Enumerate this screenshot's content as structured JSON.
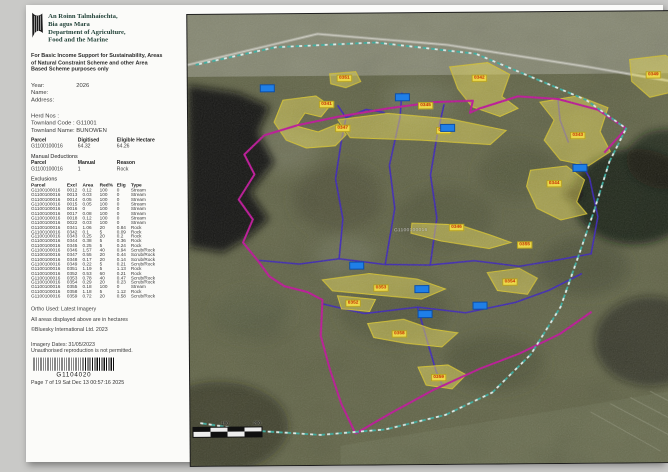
{
  "header": {
    "dept_irish_1": "An Roinn Talmhaíochta,",
    "dept_irish_2": "Bia agus Mara",
    "dept_english_1": "Department of Agriculture,",
    "dept_english_2": "Food and the Marine",
    "purpose": "For Basic Income Support for Sustainability, Areas of Natural Constraint Scheme and other Area Based Scheme purposes only"
  },
  "fields": [
    {
      "label": "Year:",
      "value": "2026"
    },
    {
      "label": "Name:",
      "value": ""
    },
    {
      "label": "Address:",
      "value": ""
    }
  ],
  "holding": [
    {
      "label": "Herd Nos :",
      "value": ""
    },
    {
      "label": "Townland Code :",
      "value": "G11001"
    },
    {
      "label": "Townland Name:",
      "value": "BUNOWEN"
    }
  ],
  "parcel_summary": {
    "headers": [
      "Parcel",
      "Digitised",
      "Eligible Hectare"
    ],
    "row": [
      "G1100100016",
      "64.32",
      "64.26"
    ]
  },
  "manual_deductions": {
    "title": "Manual Deductions",
    "headers": [
      "Parcel",
      "Manual",
      "Reason"
    ],
    "row": [
      "G1100100016",
      "1",
      "Rock"
    ]
  },
  "exclusions": {
    "title": "Exclusions",
    "headers": [
      "Parcel",
      "Excl",
      "Area",
      "Red%",
      "Elig",
      "Type"
    ],
    "rows": [
      [
        "G1100100016",
        "0012",
        "0.12",
        "100",
        "0",
        "Stream"
      ],
      [
        "G1100100016",
        "0013",
        "0.03",
        "100",
        "0",
        "Stream"
      ],
      [
        "G1100100016",
        "0014",
        "0.05",
        "100",
        "0",
        "Stream"
      ],
      [
        "G1100100016",
        "0015",
        "0.05",
        "100",
        "0",
        "Stream"
      ],
      [
        "G1100100016",
        "0016",
        "0",
        "100",
        "0",
        "Stream"
      ],
      [
        "G1100100016",
        "0017",
        "0.08",
        "100",
        "0",
        "Stream"
      ],
      [
        "G1100100016",
        "0018",
        "0.12",
        "100",
        "0",
        "Stream"
      ],
      [
        "G1100100016",
        "0022",
        "0.03",
        "100",
        "0",
        "Stream"
      ],
      [
        "G1100100016",
        "0341",
        "1.06",
        "20",
        "0.84",
        "Rock"
      ],
      [
        "G1100100016",
        "0342",
        "0.1",
        "5",
        "0.09",
        "Rock"
      ],
      [
        "G1100100016",
        "0343",
        "0.25",
        "20",
        "0.2",
        "Rock"
      ],
      [
        "G1100100016",
        "0344",
        "0.38",
        "5",
        "0.36",
        "Rock"
      ],
      [
        "G1100100016",
        "0345",
        "0.25",
        "5",
        "0.24",
        "Rock"
      ],
      [
        "G1100100016",
        "0346",
        "1.57",
        "40",
        "0.94",
        "Scrub/Rock"
      ],
      [
        "G1100100016",
        "0347",
        "0.55",
        "20",
        "0.44",
        "Scrub/Rock"
      ],
      [
        "G1100100016",
        "0348",
        "0.17",
        "20",
        "0.14",
        "Scrub/Rock"
      ],
      [
        "G1100100016",
        "0349",
        "0.22",
        "5",
        "0.21",
        "Scrub/Rock"
      ],
      [
        "G1100100016",
        "0351",
        "1.19",
        "5",
        "1.13",
        "Rock"
      ],
      [
        "G1100100016",
        "0352",
        "0.53",
        "60",
        "0.21",
        "Rock"
      ],
      [
        "G1100100016",
        "0353",
        "0.78",
        "40",
        "0.47",
        "Scrub/Rock"
      ],
      [
        "G1100100016",
        "0354",
        "0.29",
        "20",
        "0.23",
        "Scrub/Rock"
      ],
      [
        "G1100100016",
        "0355",
        "0.18",
        "100",
        "0",
        "Stream"
      ],
      [
        "G1100100016",
        "0358",
        "1.18",
        "5",
        "1.12",
        "Rock"
      ],
      [
        "G1100100016",
        "0359",
        "0.72",
        "20",
        "0.58",
        "Scrub/Rock"
      ]
    ]
  },
  "footer": {
    "ortho_line": "Ortho Used: Latest Imagery",
    "hectares_note": "All areas displayed above are in hectares",
    "copyright_line": "©Bluesky International Ltd. 2023",
    "imagery_dates": "Imagery Dates: 31/05/2023",
    "unauthorised_note": "Unauthorised reproduction is not permitted.",
    "barcode_value": "G1104020",
    "page_line": "Page 7 of 19 Sat Dec 13 00:57:16 2025"
  },
  "map": {
    "parcel_id_label": "G1100100016",
    "colors": {
      "boundary_magenta": "#c2139b",
      "boundary_teal": "#39b2a4",
      "stream_purple": "#3b22c4",
      "parcel_yellow": "#ecd94a",
      "label_red": "#c22b00",
      "marker_blue": "#1f7fe8"
    },
    "parcel_labels": [
      {
        "text": "0351",
        "x": 149,
        "y": 61
      },
      {
        "text": "0341",
        "x": 131,
        "y": 87
      },
      {
        "text": "0345",
        "x": 230,
        "y": 89
      },
      {
        "text": "0342",
        "x": 284,
        "y": 62
      },
      {
        "text": "0347",
        "x": 147,
        "y": 111
      },
      {
        "text": "0348",
        "x": 248,
        "y": 114
      },
      {
        "text": "0349",
        "x": 458,
        "y": 60
      },
      {
        "text": "0343",
        "x": 382,
        "y": 120
      },
      {
        "text": "0344",
        "x": 358,
        "y": 168
      },
      {
        "text": "0346",
        "x": 260,
        "y": 211
      },
      {
        "text": "0354",
        "x": 313,
        "y": 266
      },
      {
        "text": "0353",
        "x": 184,
        "y": 271
      },
      {
        "text": "0352",
        "x": 156,
        "y": 286
      },
      {
        "text": "0358",
        "x": 202,
        "y": 317
      },
      {
        "text": "0359",
        "x": 241,
        "y": 361
      },
      {
        "text": "0355",
        "x": 328,
        "y": 229
      }
    ],
    "blue_markers": [
      {
        "x": 72,
        "y": 70
      },
      {
        "x": 207,
        "y": 80
      },
      {
        "x": 252,
        "y": 111
      },
      {
        "x": 384,
        "y": 152
      },
      {
        "x": 160,
        "y": 248
      },
      {
        "x": 225,
        "y": 272
      },
      {
        "x": 228,
        "y": 297
      },
      {
        "x": 283,
        "y": 289
      }
    ],
    "scale_labels": [
      {
        "text": "100",
        "x": 28
      },
      {
        "text": "200",
        "x": 60
      }
    ]
  }
}
